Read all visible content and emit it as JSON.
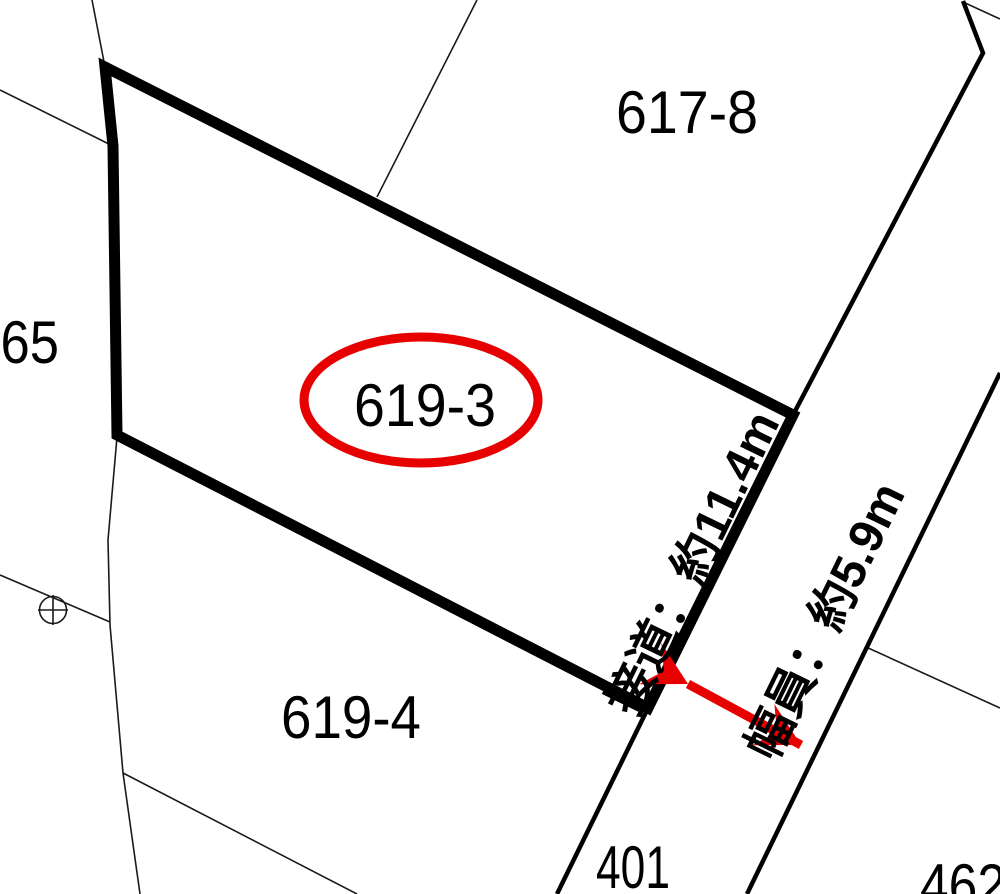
{
  "map": {
    "title": "cadastral-parcel-map",
    "parcels": {
      "p617_8": "617-8",
      "p619_3": "619-3",
      "p619_4": "619-4",
      "p401": "401",
      "p462": "462",
      "p65": "-65"
    },
    "annotations": {
      "frontage": "接道：約11.4m",
      "road_width": "幅員：約5.9m"
    },
    "highlight": {
      "selected_parcel": "619-3",
      "frontage_m": "11.4",
      "road_width_m": "5.9"
    },
    "colors": {
      "highlight_red": "#e60000",
      "boundary_black": "#000000",
      "thin_line": "#1a1a1a",
      "background": "#ffffff"
    },
    "symbols": {
      "survey_marker": "circle-cross-benchmark"
    }
  }
}
